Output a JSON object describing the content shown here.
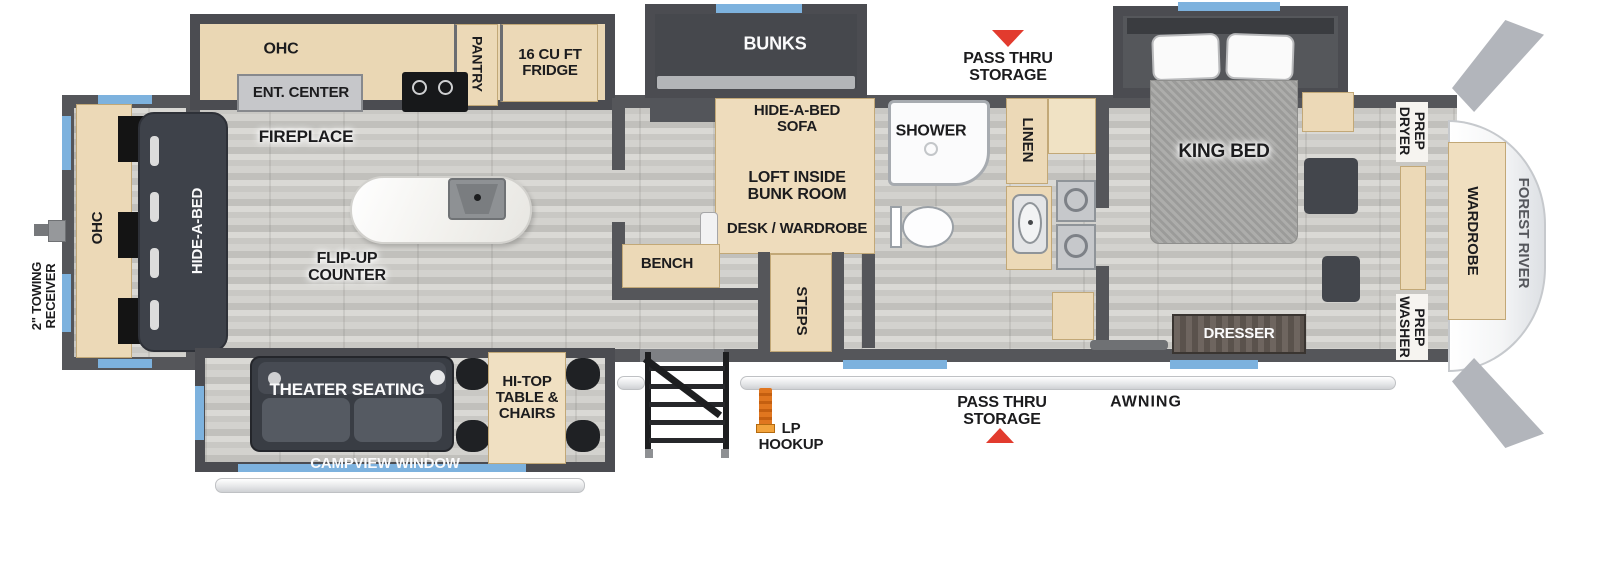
{
  "title": "Fifth wheel RV floor plan",
  "brand": "FOREST RIVER",
  "colors": {
    "wall": "#55565a",
    "floor_wood": "#cfcecA",
    "cabinet_tan": "#ecd9b7",
    "dark_furniture": "#43464c",
    "window_blue": "#7db2de",
    "arrow_red": "#e23b2e",
    "island_white": "#f7f6f4",
    "brand_gray": "#55575c"
  },
  "labels": {
    "ohc_kitchen": "OHC",
    "ent_center": "ENT. CENTER",
    "pantry": "PANTRY",
    "fridge": "16 CU FT\nFRIDGE",
    "bunks": "BUNKS",
    "pass_thru_storage_top": "PASS THRU\nSTORAGE",
    "king_bed": "KING BED",
    "dryer_prep": "DRYER\nPREP",
    "wardrobe": "WARDROBE",
    "forest_river": "FOREST RIVER",
    "washer_prep": "WASHER\nPREP",
    "dresser": "DRESSER",
    "linen": "LINEN",
    "shower": "SHOWER",
    "hide_a_bed_sofa": "HIDE-A-BED\nSOFA",
    "loft_inside": "LOFT INSIDE\nBUNK ROOM",
    "desk_wardrobe": "DESK / WARDROBE",
    "bench": "BENCH",
    "steps": "STEPS",
    "fireplace": "FIREPLACE",
    "flip_up_counter": "FLIP-UP\nCOUNTER",
    "hide_a_bed": "HIDE-A-BED",
    "ohc_rear": "OHC",
    "towing_receiver": "2\" TOWING\nRECEIVER",
    "theater_seating": "THEATER SEATING",
    "hi_top_table": "HI-TOP\nTABLE &\nCHAIRS",
    "campview_window": "CAMPVIEW WINDOW",
    "lp_hookup": "LP\nHOOKUP",
    "pass_thru_storage_bottom": "PASS THRU\nSTORAGE",
    "awning": "AWNING"
  }
}
